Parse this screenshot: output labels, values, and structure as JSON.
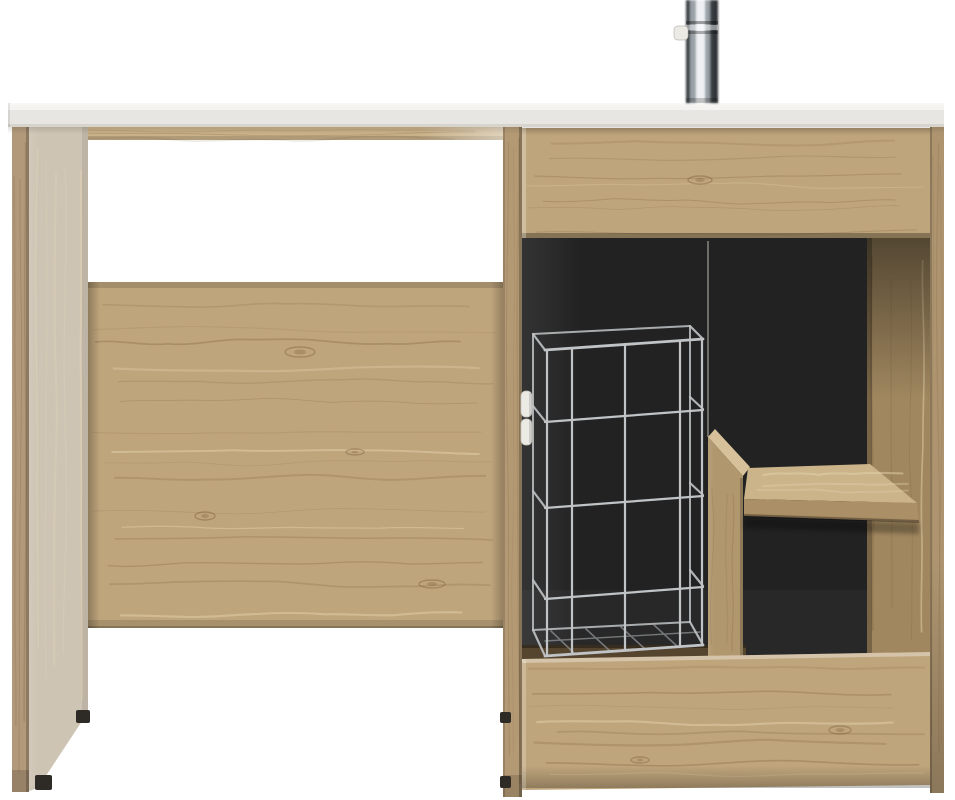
{
  "scene": {
    "description": "Product photo of an oak-effect utility cabinet unit with a white worktop, chrome tap, open appliance recess on the left, and a right-hand cabinet containing a chrome wire basket, wooden divider, shelf and drawers, on a plain white background",
    "parts": [
      {
        "id": "worktop",
        "label": "white worktop"
      },
      {
        "id": "tap",
        "label": "chrome tap"
      },
      {
        "id": "left-leg",
        "label": "left side panel"
      },
      {
        "id": "appliance-recess",
        "label": "open appliance recess"
      },
      {
        "id": "back-panel",
        "label": "oak back panel"
      },
      {
        "id": "top-drawer",
        "label": "top drawer front"
      },
      {
        "id": "wire-basket",
        "label": "chrome wire basket"
      },
      {
        "id": "divider",
        "label": "vertical divider board"
      },
      {
        "id": "shelf",
        "label": "internal shelf"
      },
      {
        "id": "bottom-drawer",
        "label": "bottom drawer front"
      },
      {
        "id": "right-panel",
        "label": "right side panel"
      }
    ]
  },
  "palette": {
    "background": "#ffffff",
    "counterTop": "#f4f3f0",
    "counterFace": "#e8e6e2",
    "counterEdge": "#d7d3cd",
    "woodRail": "#c9b189",
    "woodBase": "#bfa57c",
    "woodPale": "#cec4b4",
    "woodStrip": "#b2997a",
    "woodWall": "#b49a74",
    "woodDivider": "#b1976e",
    "woodDividerTop": "#d6c19a",
    "woodShelfTop": "#cbb38a",
    "woodShelfFront": "#ab8f66",
    "woodInnerWall": "#a0875f",
    "woodRight": "#ae9570",
    "woodFloor": "#55452f",
    "grainDark": "#77593a",
    "grainLight": "#e6d6b2",
    "interior": "#222222",
    "wire": "#c0c4c6",
    "wireDark": "#8e9294",
    "seam": "#b5b1aa",
    "chromeLight": "#eef1f3",
    "chromeMid": "#9aa1a7",
    "chromeDark": "#3a3f43",
    "chromeEdge": "#2e3236",
    "feet": "#2e2b27",
    "hinge": "#eceae5"
  }
}
